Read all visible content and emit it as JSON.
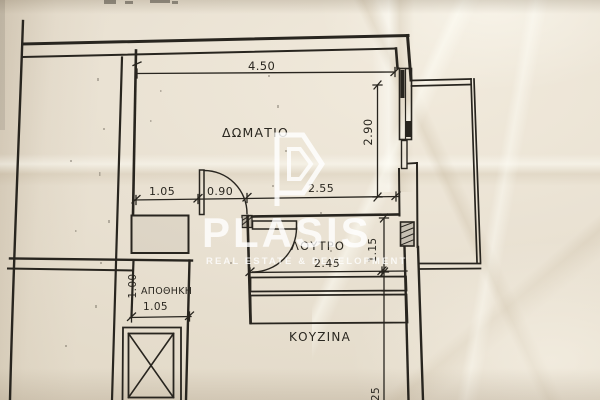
{
  "photo": {
    "plan": {
      "room_labels": {
        "bedroom": "ΔΩΜΑΤΙΟ",
        "bathroom": "ΛΟΥΤΡΟ",
        "storage": "ΑΠΟΘΗΚΗ",
        "kitchen": "ΚΟΥΖΙΝΑ"
      },
      "dimensions": {
        "bedroom_width": "4.50",
        "bedroom_depth": "2.90",
        "hall_segment": "1.05",
        "entry_door": "0.90",
        "hall_to_wall": "2.55",
        "bathroom_width": "2.45",
        "bathroom_depth": "1.15",
        "storage_depth": "1.00",
        "storage_width": "1.05",
        "kitchen_partial": "25"
      }
    },
    "watermark": {
      "brand": "PLASIS",
      "tagline": "REAL ESTATE & DEVELOPMENT"
    },
    "colors": {
      "paper": "#e9e1d2",
      "ink": "#28251f",
      "watermark_white": "#ffffff"
    }
  }
}
